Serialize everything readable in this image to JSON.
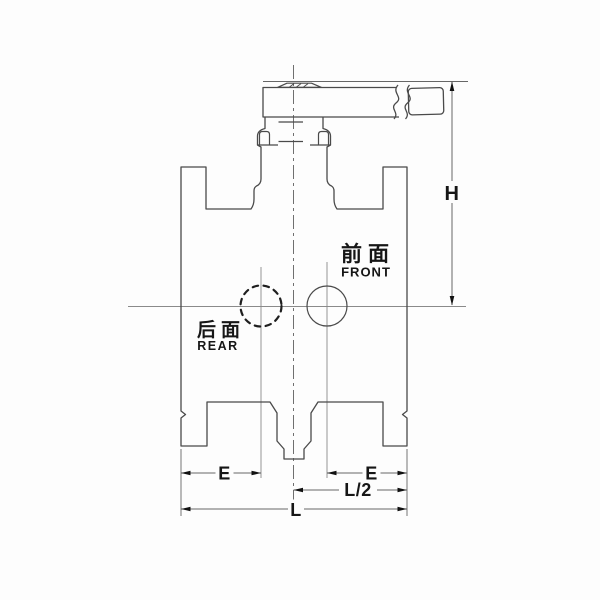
{
  "drawing": {
    "type": "valve-front-view-technical-drawing",
    "annotations": {
      "front_cn": "前面",
      "front_en": "FRONT",
      "rear_cn": "后面",
      "rear_en": "REAR"
    },
    "dimensions": {
      "height_label": "H",
      "e_left_label": "E",
      "e_right_label": "E",
      "half_length_label": "L/2",
      "length_label": "L"
    },
    "colors": {
      "outline": "#4a4a4a",
      "dimension_line": "#666666",
      "centerline": "#777777",
      "label_text": "#161616",
      "background": "#fdfdfd"
    }
  }
}
